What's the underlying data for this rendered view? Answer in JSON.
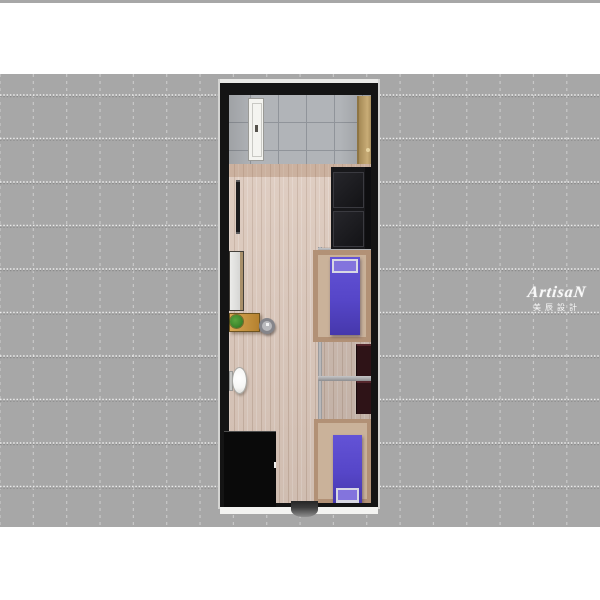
{
  "image": {
    "type": "interior-floor-plan-3d-render",
    "view": "top-down",
    "description": "3D rendered top-down floor plan of a narrow studio room on a gray grid background"
  },
  "watermark": {
    "brand": "ArtisaN",
    "subtitle": "美辰設計"
  },
  "colors": {
    "background": "#a7a7a7",
    "margin": "#ffffff",
    "wall": "#141414",
    "tile": "#b1b4b8",
    "tile_grout": "#90949a",
    "wood": "#dbc7ba",
    "bed": "#5646c8",
    "pillow": "#8374dd",
    "pillow_trim": "#d8d8e4",
    "sofa": "#18181b",
    "sofa_dark": "#0e0e10",
    "nightstand": "#2e1317",
    "desk": "#c3913f",
    "plant": "#3f8a2e",
    "plant_dark": "#2a6420",
    "door_white": "#f4f4f0",
    "door_tan": "#c1a164",
    "wardrobe_side": "#a88f69",
    "metal": "#c6c6c8",
    "metal_dark": "#8d8d8f",
    "mat": "#0a0a0a",
    "entry_mat": "#3c3c3c",
    "tv": "#1c1c1e",
    "toilet": "#f6f6f4",
    "frame_wood": "#b29176",
    "frame_wood_light": "#cab29a",
    "ground": "#f3f3f1",
    "highlight": "#e9e9e7"
  },
  "furniture": [
    {
      "name": "entry-door-white",
      "label": "white entry door leaf"
    },
    {
      "name": "entry-door-tan",
      "label": "tan cabinet / door panel"
    },
    {
      "name": "tv",
      "label": "wall-mounted TV"
    },
    {
      "name": "sofa",
      "label": "black two-seat sofa"
    },
    {
      "name": "wardrobe",
      "label": "tall cabinet"
    },
    {
      "name": "desk",
      "label": "wooden desk"
    },
    {
      "name": "plant",
      "label": "potted plant"
    },
    {
      "name": "stool",
      "label": "round stool"
    },
    {
      "name": "toilet",
      "label": "toilet"
    },
    {
      "name": "bed-1",
      "label": "single bed with purple mattress (upper)"
    },
    {
      "name": "bed-2",
      "label": "single bed with purple mattress (lower)"
    },
    {
      "name": "nightstand-1",
      "label": "dark nightstand (upper)"
    },
    {
      "name": "nightstand-2",
      "label": "dark nightstand (lower)"
    },
    {
      "name": "black-mat",
      "label": "black floor area"
    },
    {
      "name": "entry-mat",
      "label": "entrance step mat"
    },
    {
      "name": "partition-rail",
      "label": "metal partition rail"
    }
  ]
}
